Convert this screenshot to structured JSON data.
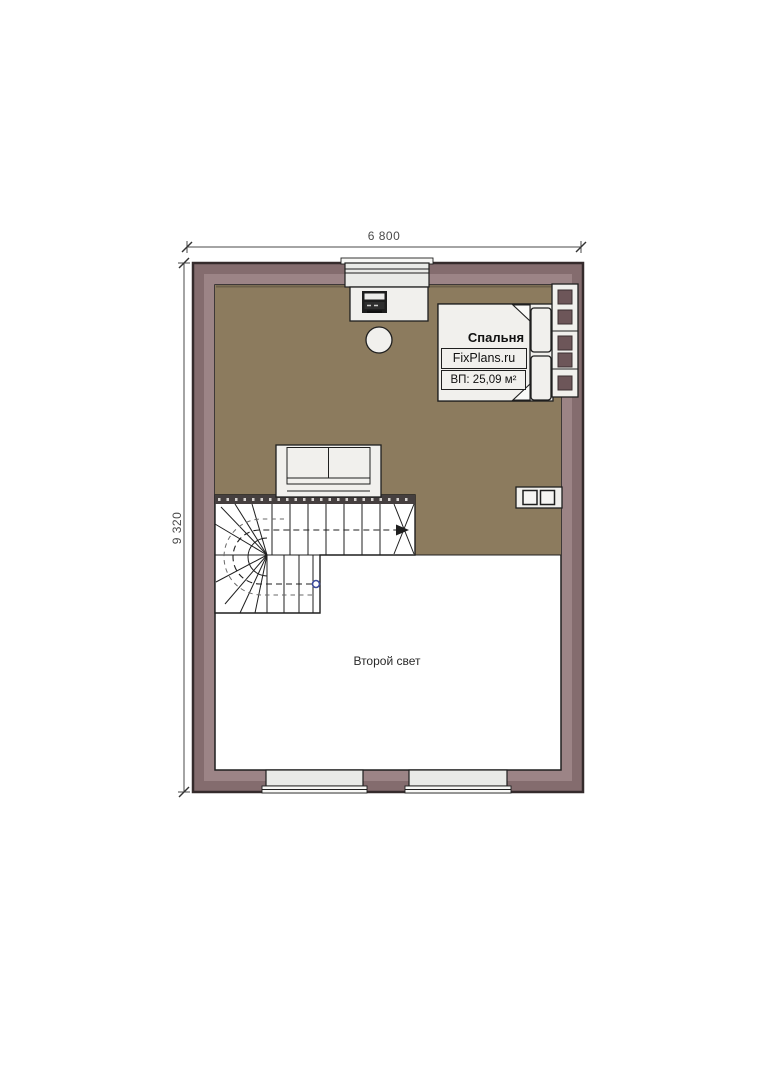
{
  "plan": {
    "dimensions": {
      "width_label": "6 800",
      "height_label": "9 320"
    },
    "room": {
      "name": "Спальня",
      "watermark": "FixPlans.ru",
      "area": "ВП: 25,09 м²"
    },
    "labels": {
      "second_light": "Второй свет"
    },
    "elements": [
      "bed",
      "pillows",
      "blanket",
      "drawer-unit",
      "small-cabinet",
      "desk",
      "computer-monitor",
      "stool",
      "sofa",
      "winder-staircase",
      "walk-line",
      "top-window",
      "bottom-window-left",
      "bottom-window-right"
    ]
  },
  "colors": {
    "wall-fill": "#846c6e",
    "wall-light": "#9c8486",
    "wall-outline": "#352b2c",
    "floor-brown": "#8c7b5e",
    "furniture-fill": "#f1f0ed",
    "window-fill": "#e9eae7",
    "drawer-square": "#6d5659",
    "line": "#1f1f1f",
    "dim": "#4a4a4a",
    "walkline-start": "#3b4a9b"
  }
}
